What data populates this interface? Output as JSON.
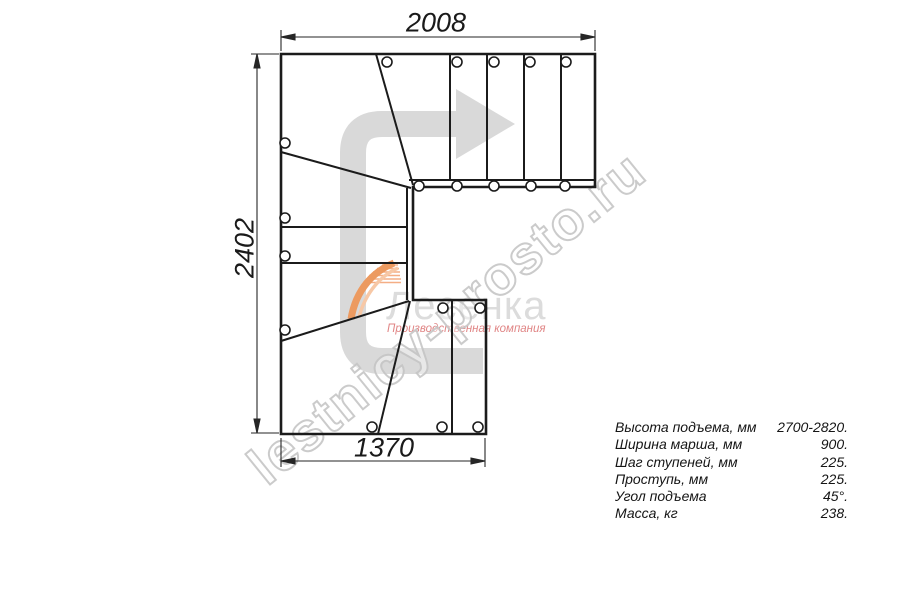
{
  "dimensions": {
    "top": "2008",
    "left": "2402",
    "bottom": "1370"
  },
  "specs": {
    "rows": [
      {
        "label": "Высота подъема, мм",
        "value": "2700-2820."
      },
      {
        "label": "Ширина марша, мм",
        "value": "900."
      },
      {
        "label": "Шаг ступеней, мм",
        "value": "225."
      },
      {
        "label": "Проступь, мм",
        "value": "225."
      },
      {
        "label": "Угол подъема",
        "value": "45°."
      },
      {
        "label": "Масса, кг",
        "value": "238."
      }
    ]
  },
  "watermark": {
    "text": "lestnicy-prosto.ru"
  },
  "logo": {
    "title": "Лесенка",
    "tagline": "Производственная компания"
  },
  "icons": {
    "direction_arrow": "direction-arrow-icon",
    "logo_swoosh": "logo-swoosh-icon"
  },
  "colors": {
    "drawing_line": "#1b1b1b",
    "dimension_line": "#262626",
    "arrow_gray": "#d9d9d9",
    "watermark_gray": "#c6c6c6",
    "logo_text_gray": "#dcdcdc",
    "logo_orange": "#ec9a60",
    "logo_tagline_pink": "#e08585"
  }
}
